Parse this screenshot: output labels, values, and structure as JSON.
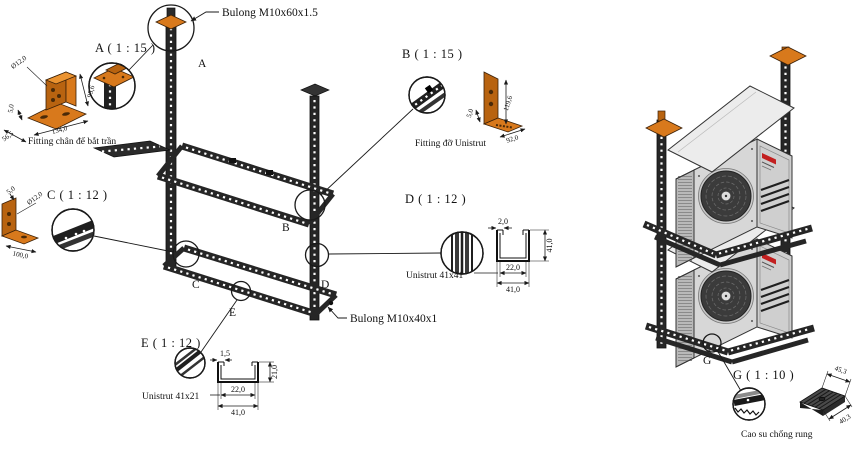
{
  "colors": {
    "line": "#1a1a1a",
    "bracket_orange": "#d8791c",
    "unit_gray": "#d7d7d7",
    "logo_red": "#c21f1f"
  },
  "left_assembly": {
    "bolt_top_label": "Bulong M10x60x1.5",
    "bolt_mid_label": "Bulong M10x40x1",
    "marker_a": "A",
    "marker_b": "B",
    "marker_c": "C",
    "marker_d": "D",
    "marker_e": "E"
  },
  "right_assembly": {
    "marker_g": "G"
  },
  "details": {
    "a": {
      "title": "A ( 1 : 15 )",
      "caption": "Fitting chân đế bắt trần",
      "dim_hole": "Ø12,0",
      "dim_height": "95,6",
      "dim_thickness": "5,0",
      "dim_depth": "56,5",
      "dim_width": "134,0"
    },
    "b": {
      "title": "B ( 1 : 15 )",
      "caption": "Fitting đỡ Unistrut",
      "dim_height": "119,6",
      "dim_width": "92,0",
      "dim_thickness": "5,0"
    },
    "c": {
      "title": "C ( 1 : 12 )",
      "dim_thickness": "5,0",
      "dim_hole": "Ø12,0",
      "dim_length": "100,0"
    },
    "d": {
      "title": "D ( 1 : 12 )",
      "caption": "Unistrut 41x41",
      "dim_lip": "2,0",
      "dim_height": "41,0",
      "dim_inner": "22,0",
      "dim_width": "41,0"
    },
    "e": {
      "title": "E ( 1 : 12 )",
      "caption": "Unistrut 41x21",
      "dim_lip": "1,5",
      "dim_height": "21,0",
      "dim_inner": "22,0",
      "dim_width": "41,0"
    },
    "g": {
      "title": "G ( 1 : 10 )",
      "caption": "Cao su chống rung",
      "dim_width": "45,3",
      "dim_depth": "40,3"
    }
  }
}
